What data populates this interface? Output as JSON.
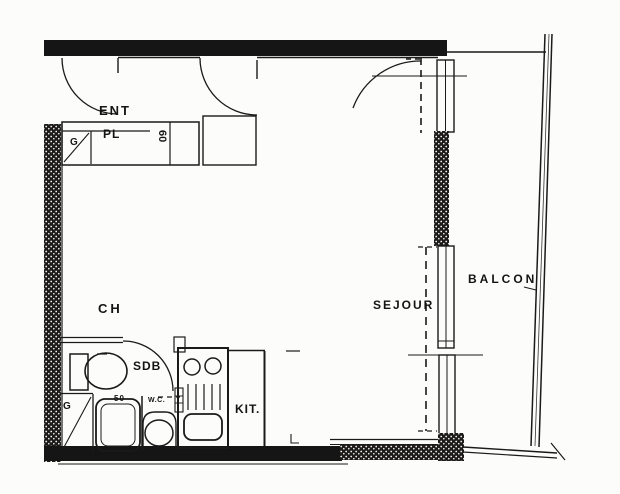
{
  "plan": {
    "rooms": {
      "entrance": "ENT",
      "closet": "PL",
      "bedroom": "CH",
      "bathroom": "SDB",
      "kitchen": "KIT.",
      "living_room": "SEJOUR",
      "balcony": "BALCON"
    },
    "annotations": {
      "duct_top": "G",
      "duct_bottom": "G",
      "closet_depth": "60",
      "shower_dim": "50",
      "wc": "W.C."
    },
    "colors": {
      "ink": "#1a1a1a",
      "wall_fill": "#151515",
      "paper": "#fcfcfb"
    }
  }
}
